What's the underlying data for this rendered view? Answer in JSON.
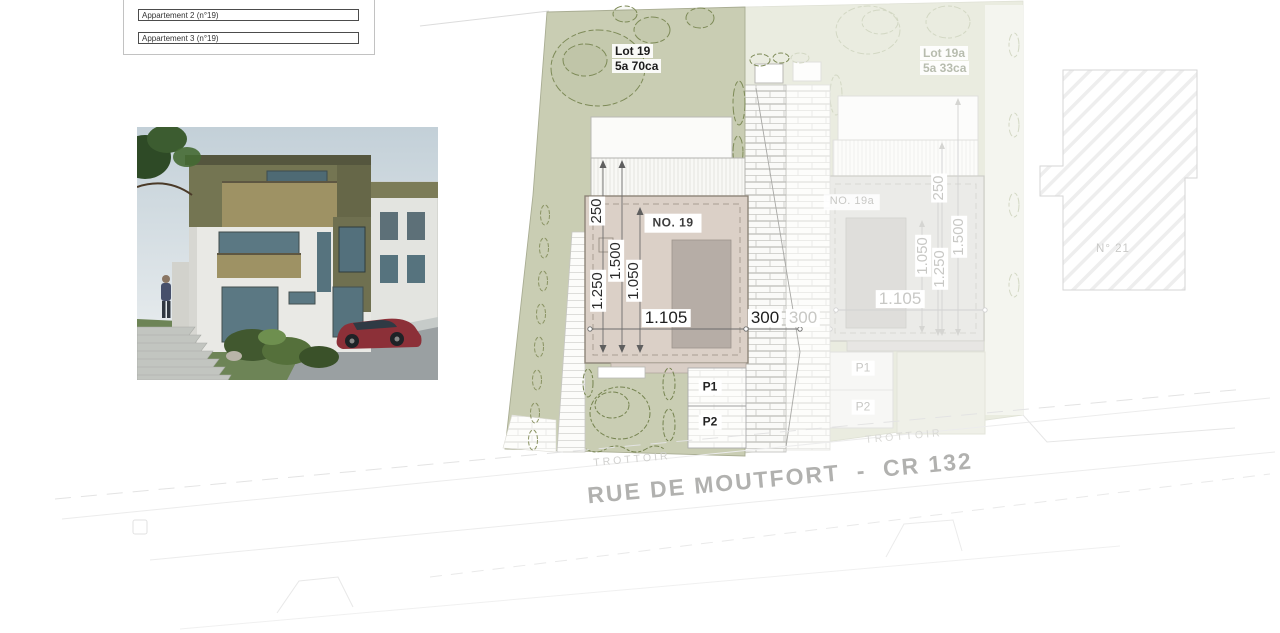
{
  "legend": {
    "items": [
      {
        "label": "Appartement 2 (n°19)"
      },
      {
        "label": "Appartement 3 (n°19)"
      }
    ]
  },
  "site_plan": {
    "lot19": {
      "name": "Lot 19",
      "area": "5a 70ca",
      "building": "NO. 19",
      "parking": {
        "p1": "P1",
        "p2": "P2"
      },
      "dims": {
        "setback": "250",
        "depth_total": "1.500",
        "depth_inner": "1.050",
        "depth_building": "1.250",
        "width": "1.105",
        "side": "300"
      }
    },
    "lot19a": {
      "name": "Lot 19a",
      "area": "5a 33ca",
      "building": "NO. 19a",
      "parking": {
        "p1": "P1",
        "p2": "P2"
      },
      "dims": {
        "setback": "250",
        "depth_total": "1.500",
        "depth_inner": "1.050",
        "depth_building": "1.250",
        "width": "1.105",
        "side": "300"
      }
    },
    "neighbor": {
      "label": "N° 21"
    },
    "street": {
      "name": "RUE DE MOUTFORT  -  CR 132",
      "sidewalk_left": "TROTTOIR",
      "sidewalk_right": "TROTTOIR"
    }
  },
  "colors": {
    "lot_green": "#c9cdb3",
    "lot_green_faded": "#eaece0",
    "building_tan": "#dbd0c7",
    "building_core_gray": "#b6ada6",
    "faded_building": "#ebebe8",
    "dim_dark": "#2b2b2b",
    "dim_faded": "#c8c8c5",
    "street_text": "#b1b1af",
    "tree_stroke": "#7d8a57"
  }
}
